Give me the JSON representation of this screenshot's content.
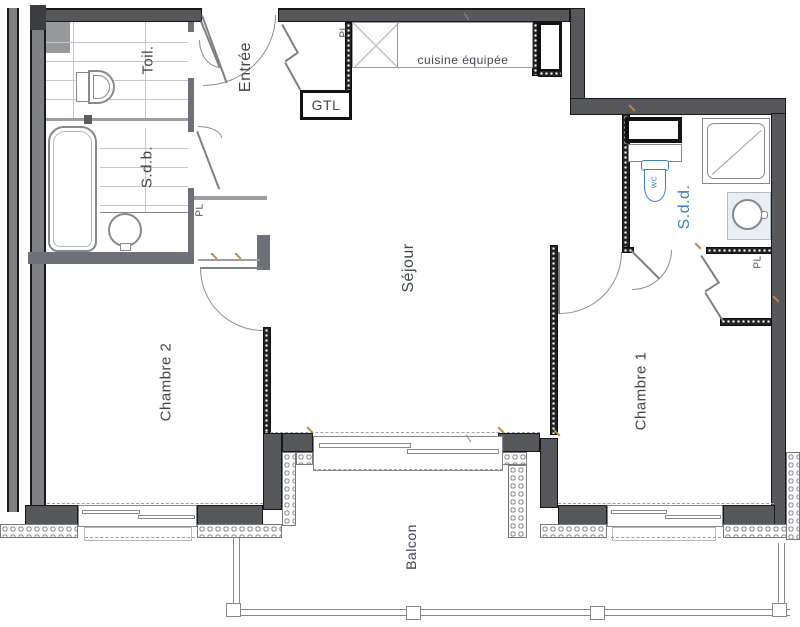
{
  "title": "Apartment floor plan",
  "labels": {
    "entree": "Entrée",
    "toilet": "Toil.",
    "bathroom": "S.d.b.",
    "shower_room": "S.d.d.",
    "living": "Séjour",
    "bedroom1": "Chambre 1",
    "bedroom2": "Chambre 2",
    "balcony": "Balcon",
    "kitchen": "cuisine équipée",
    "gtl": "GTL",
    "wc": "WC",
    "closet_hall": "PL",
    "closet_entry": "PL",
    "closet_bedroom1": "PL"
  },
  "colors": {
    "wall_dark": "#57585c",
    "wall_mid": "#6d7076",
    "label": "#3f464f",
    "accent_blue": "#3c7ec9",
    "tick_orange": "#c0883f"
  }
}
